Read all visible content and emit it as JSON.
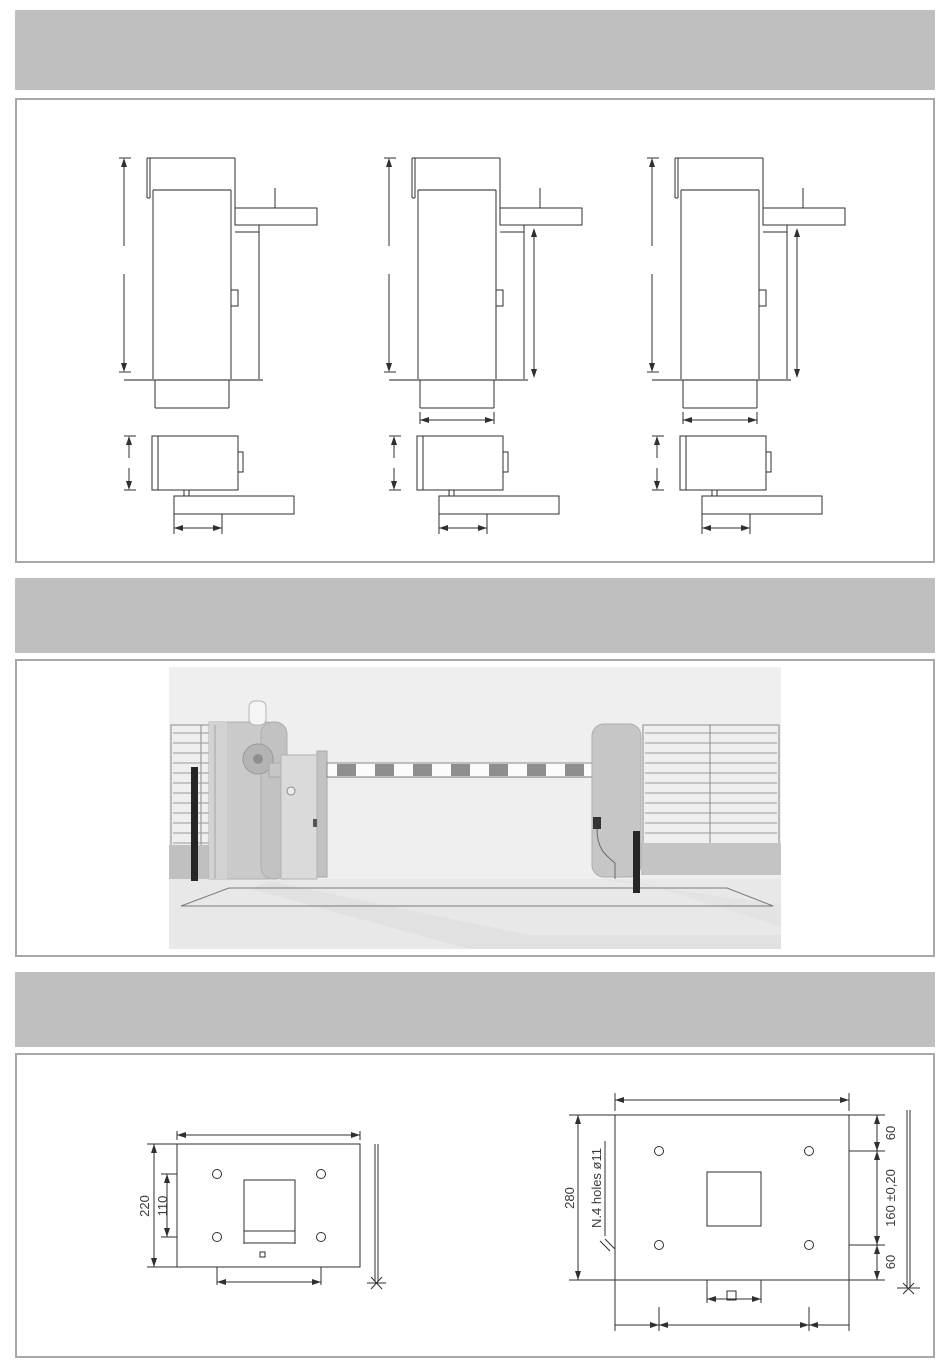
{
  "bands": {
    "count": 3,
    "text": ""
  },
  "colors": {
    "band_gray": "#bfbfbf",
    "panel_border": "#a8a8a8",
    "drawing_line": "#2f2f2f",
    "photo_background": "#eeeeee",
    "boom_stripe": "#8e8e8e"
  },
  "plates": {
    "left": {
      "overall_height": "220",
      "inner_spacing": "110"
    },
    "right": {
      "overall_height": "280",
      "holes_note": "N.4 holes ø11",
      "edge_top": "60",
      "center_tolerance": "160 ±0,20",
      "edge_bottom": "60"
    }
  }
}
